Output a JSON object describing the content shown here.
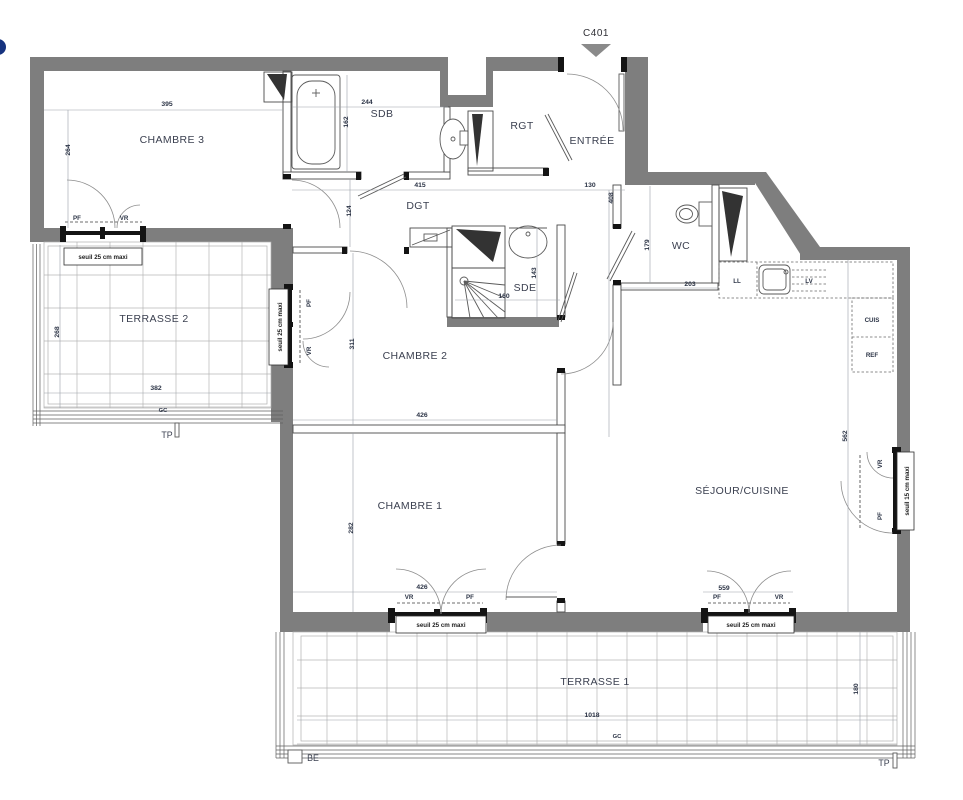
{
  "title": {
    "unit": "C401"
  },
  "rooms": {
    "chambre3": "CHAMBRE 3",
    "sdb": "SDB",
    "rgt": "RGT",
    "entree": "ENTRÉE",
    "dgt": "DGT",
    "wc": "WC",
    "sde": "SDE",
    "chambre2": "CHAMBRE 2",
    "chambre1": "CHAMBRE 1",
    "sejour_cuisine": "SÉJOUR/CUISINE",
    "terrasse1": "TERRASSE 1",
    "terrasse2": "TERRASSE 2"
  },
  "kitchen": {
    "ll": "LL",
    "lv": "LV",
    "cuis": "CUIS",
    "ref": "REF"
  },
  "dimensions": {
    "chambre3_width": "395",
    "chambre3_depth": "264",
    "sdb_width": "244",
    "sdb_depth": "162",
    "dgt_length": "415",
    "dgt_width": "124",
    "entree_width": "130",
    "entree_depth": "408",
    "wc_depth": "179",
    "wc_width": "203",
    "sde_depth": "143",
    "sde_width": "160",
    "chambre2_depth": "311",
    "chambre2_width": "426",
    "chambre1_depth": "282",
    "chambre1_width": "426",
    "sejour_depth": "562",
    "sejour_window": "559",
    "terrasse2_depth": "268",
    "terrasse2_width": "382",
    "terrasse1_width": "1018",
    "terrasse1_depth": "180"
  },
  "openings": {
    "pf": "PF",
    "vr": "VR",
    "seuil_25": "seuil 25 cm maxi",
    "seuil_15": "seuil 15 cm maxi"
  },
  "annotations": {
    "gc": "GC",
    "tp": "TP",
    "be": "BE"
  },
  "colors": {
    "wall": "#7e7e7e",
    "line": "#4a4a4a",
    "text": "#3b4050",
    "logo_blue": "#16337f"
  }
}
